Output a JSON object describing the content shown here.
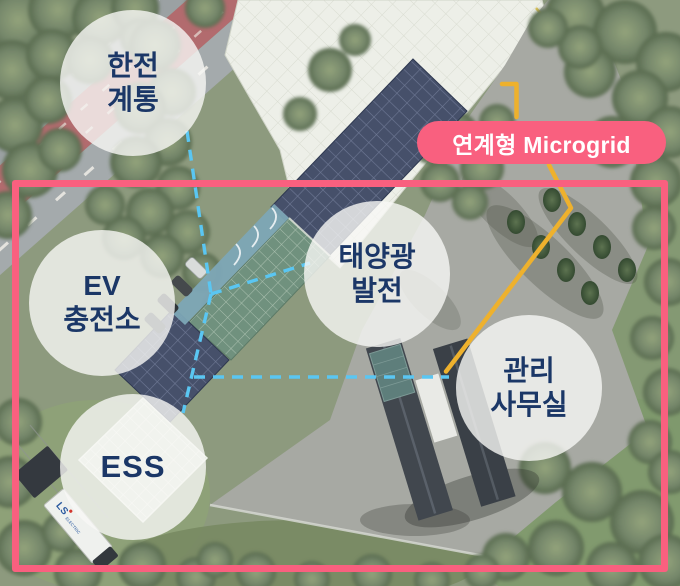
{
  "banner": {
    "label": "연계형 Microgrid"
  },
  "bubbles": {
    "kepco": {
      "line1": "한전",
      "line2": "계통"
    },
    "ev": {
      "line1": "EV",
      "line2": "충전소"
    },
    "solar": {
      "line1": "태양광",
      "line2": "발전"
    },
    "office": {
      "line1": "관리",
      "line2": "사무실"
    },
    "ess": {
      "line1": "ESS"
    }
  },
  "truck": {
    "brand": "LS",
    "brand_suffix": "ELECTRIC"
  },
  "colors": {
    "accent_pink": "#f9607f",
    "connection_blue": "#5ac6f2",
    "cable_yellow": "#eeb12d",
    "label_navy": "#1b3767"
  }
}
